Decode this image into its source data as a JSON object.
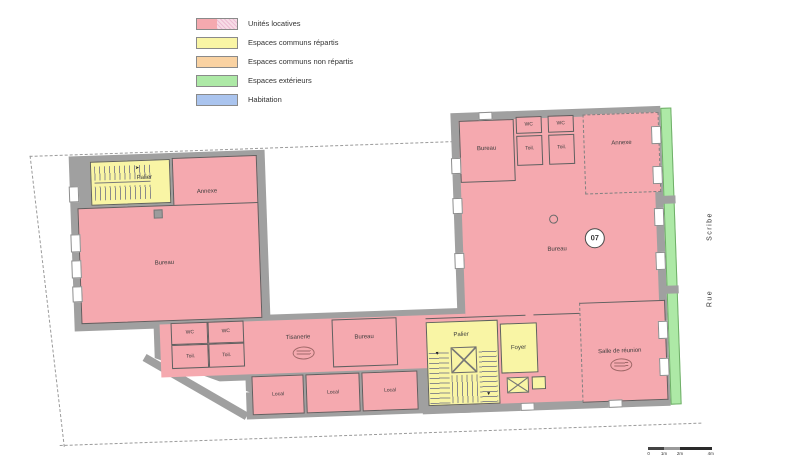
{
  "legend": {
    "items": [
      {
        "label": "Unités locatives",
        "color": "#f5a9af",
        "color2": "#f7dce6"
      },
      {
        "label": "Espaces communs répartis",
        "color": "#f9f5a5"
      },
      {
        "label": "Espaces communs non répartis",
        "color": "#f9d2a2"
      },
      {
        "label": "Espaces extérieurs",
        "color": "#ade9a6"
      },
      {
        "label": "Habitation",
        "color": "#aac4ee"
      }
    ]
  },
  "plan": {
    "rooms": {
      "palier": "Palier",
      "annexe": "Annexe",
      "bureau": "Bureau",
      "wc": "WC",
      "toilettes": "Toil.",
      "tisanerie": "Tisanerie",
      "local": "Local",
      "foyer": "Foyer",
      "salle_reunion": "Salle de réunion"
    },
    "unit_number": "07",
    "colors": {
      "unit": "#f5a9af",
      "common_shared": "#f9f5a5",
      "common_unshared": "#f9d2a2",
      "exterior": "#ade9a6",
      "habitation": "#aac4ee",
      "wall": "#a0a0a0"
    }
  },
  "street": {
    "top": "Scribe",
    "bottom": "Rue"
  },
  "scale_bar": {
    "ticks": [
      "0",
      "1m",
      "2m",
      "4m"
    ]
  }
}
